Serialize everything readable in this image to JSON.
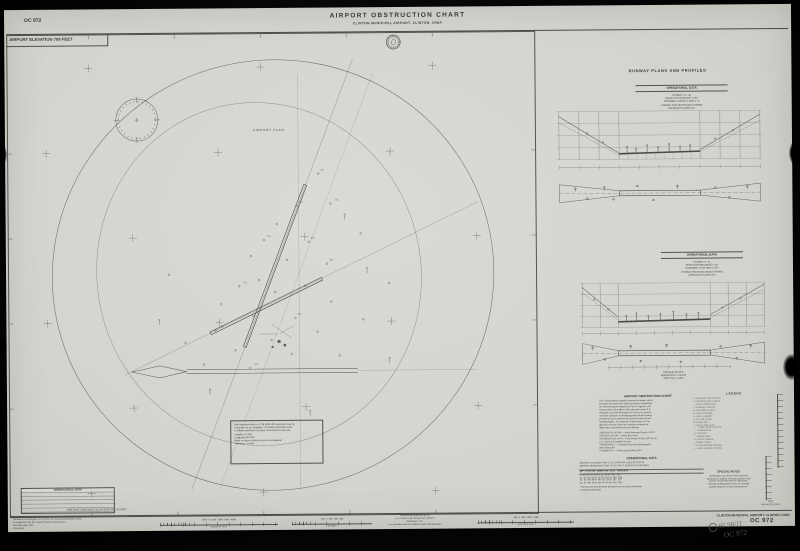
{
  "header": {
    "chart_number": "OC 972",
    "title": "AIRPORT OBSTRUCTION CHART",
    "subtitle": "CLINTON MUNICIPAL AIRPORT, CLINTON, IOWA",
    "elevation_label": "AIRPORT ELEVATION 708 FEET"
  },
  "map": {
    "plan_label": "AIRPORT PLAN",
    "feet_note": "OBSTRUCTIONS AND ELEVATIONS ARE IN FEET",
    "note_lines": [
      "Field elevation datum of 708 (MSL 29') surveyed; may be",
      "hazardous to air navigation. For latest information refer",
      "to official verification services of the NOS for airports:",
      "   Latitude        41°49'N",
      "   Longitude       90°19'W",
      "Items on these surfaces refer to aeronautical",
      "   × denotes  – in feet"
    ],
    "aero_table_title": "AERONAUTICAL DATA",
    "spot_elevations": [
      "761",
      "792",
      "748",
      "836",
      "715",
      "788",
      "742",
      "799",
      "768",
      "723"
    ]
  },
  "right_panel": {
    "title": "RUNWAY PLANS AND PROFILES",
    "profile1": {
      "table_title": "OPERATIONAL DATA",
      "data_lines": [
        "RUNWAY 14 - 32",
        "EFFECTIVE GRADIENT  0.3%",
        "PAVEMENT  ASPHALT  4000 X 75",
        "RUNWAY END ELEVATIONS SHOWN",
        "APPROACH SLOPE  34:1"
      ]
    },
    "profile2": {
      "table_title": "OPERATIONAL DATA",
      "data_lines": [
        "RUNWAY 3 - 21",
        "EFFECTIVE GRADIENT  0.2%",
        "PAVEMENT  TURF  2650 X 150",
        "RUNWAY END ELEVATIONS SHOWN",
        "APPROACH SLOPE  20:1"
      ],
      "caption_lines": [
        "PROFILE SCALES",
        "HORIZONTAL  1:12,000",
        "VERTICAL  1:1,200"
      ]
    }
  },
  "description": {
    "title": "AIRPORT OBSTRUCTION CHART",
    "para1_lines": [
      "This chart presents a graphic portrayal of objects which",
      "penetrate the obstruction clearing surfaces established",
      "by Federal Aviation Regulations Part 77 together with",
      "runway plans and profiles of the approach areas. It is",
      "designed to provide information for use by air carriers",
      "and other operators in developing take-off and landing",
      "procedures and in determining maximum take-off and",
      "landing weights. The absence of obstructions on the",
      "approach surfaces does not constitute authority for",
      "flight below prescribed minimum altitudes."
    ],
    "para2_lines": [
      "HORIZONTAL DATUM — North American Datum of 1927",
      "VERTICAL DATUM — Mean Sea Level",
      "AERONAUTICAL DATA — Field survey of May 1967 by the",
      "      U.S. Coast and Geodetic Survey",
      "TOPOGRAPHY — Compiled from aerial photographs",
      "      taken April 1967",
      "PLANIMETRY — Field inspected May 1967"
    ]
  },
  "legend": {
    "title": "LEGEND",
    "items": [
      "⊙   Obstruction with elevation",
      "○   Obstruction (top of object)",
      "◌   Group of obstructions",
      "▭   Building or structure",
      "●   Tank (water, oil, gas)",
      "◍   Stack or chimney",
      "△   Tower or antenna",
      "·    Pole, post or sign",
      "✤   Isolated tree",
      "∴   Trees or brush area",
      "─○─ Power transmission line",
      "──  Telephone line",
      "××  Fence line",
      "╌╌  Railroad track",
      "══  Road or highway",
      "∼   Stream or ditch",
      "×708 Spot elevation (ground)",
      "–·–  Airport property boundary"
    ]
  },
  "operational_table": {
    "title": "OPERATIONAL DATA",
    "line1": "AIRPORT ELEVATION 708 FT      LAT 41°49'47\"N   LONG 90°19'57\"W",
    "line2": "AIRPORT REFERENCE POINT       ELEV 706 FT  (CENTER OF AIRPORT)",
    "col_header": "RWY    LATITUDE       LONGITUDE      ELEV   THRESHOLD",
    "rows": [
      " 3     41°49'32\"N    90°20'14\"W    705      705",
      "21     41°50'02\"N    90°19'38\"W    708      708",
      "14     41°50'00\"N    90°20'10\"W    707      707",
      "32     41°49'33\"N    90°19'40\"W    703      703"
    ],
    "footnotes": [
      "* Runway end and threshold elevations are at runway centerline.",
      "† Displaced threshold."
    ]
  },
  "special_notes": {
    "title": "SPECIAL NOTES",
    "lines": [
      "All elevations are above mean sea level.",
      "Obstruction numbers are index numbers only",
      "and do not indicate order of importance.",
      "Runway profile grades shown are average",
      "grades between runway end elevations."
    ]
  },
  "vscale_caption": [
    "FEET",
    "MEAN SEA LEVEL"
  ],
  "footer": {
    "left_lines": [
      "Published at Washington, D.C. by the U.S. Coast and Geodetic Survey",
      "in cooperation with the Federal Aviation Administration.",
      "5th Edition  May 1967",
      "Price $1.00"
    ],
    "sb1_numbers": "1000      0      1000     2000     3000     4000",
    "sb1_label": "SCALE OF FEET",
    "sb2_numbers": "200    0    200    400    600",
    "sb2_label": "METERS",
    "credit_lines": [
      "Prepared and published by the",
      "U.S. COAST AND GEODETIC SURVEY",
      "Washington, D.C.",
      "In cooperation with the Federal Aviation Administration"
    ],
    "sb3_numbers": "500   0   500   1000   1500",
    "sb3_label": "SCALE OF FEET",
    "airport_name": "CLINTON MUNICIPAL AIRPORT, CLINTON, IOWA",
    "chart_number": "OC 972",
    "handwriting": [
      "95  98/11",
      "OC 972"
    ]
  }
}
